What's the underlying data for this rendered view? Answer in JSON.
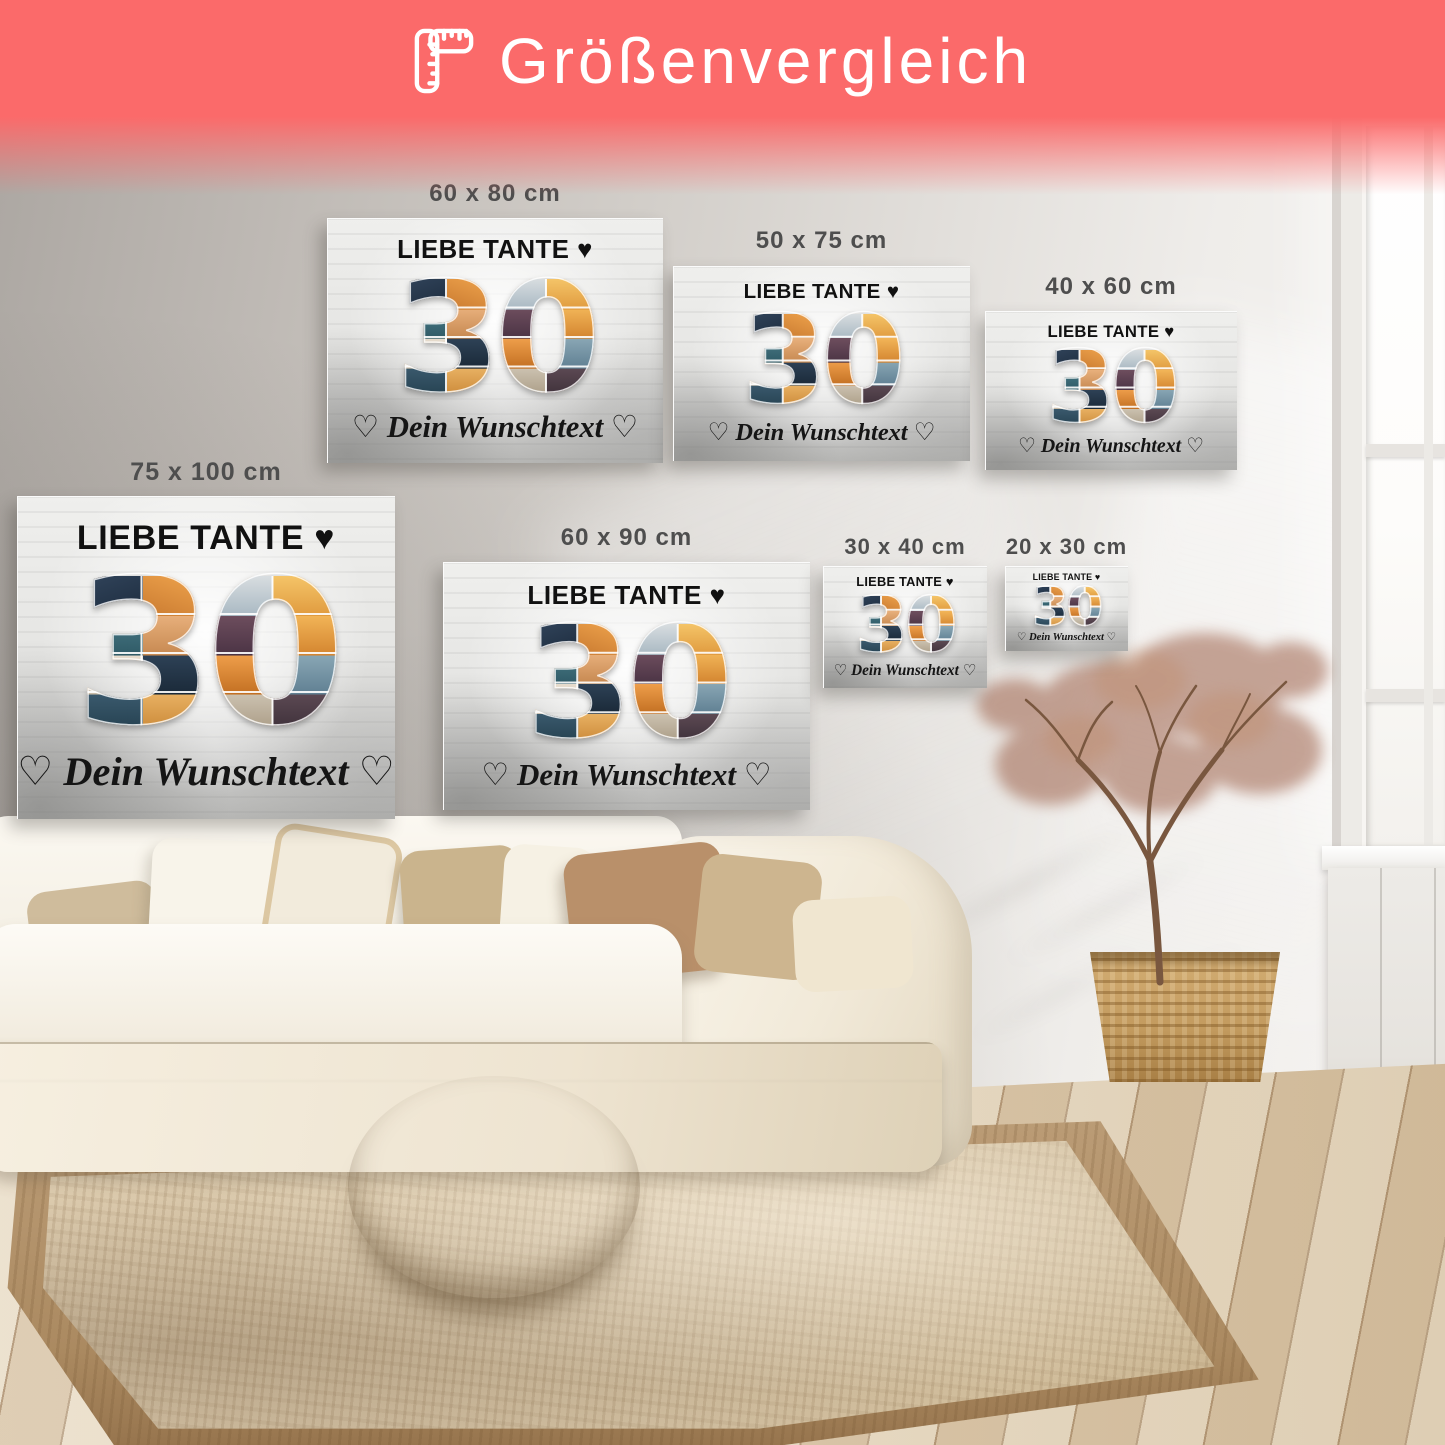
{
  "header": {
    "title": "Größenvergleich",
    "icon": "ruler-icon",
    "banner_color": "#fb6a6a",
    "text_color": "#ffffff"
  },
  "canvas_design": {
    "headline": "LIEBE TANTE ♥",
    "number": "30",
    "subtitle": "♡ Dein Wunschtext ♡"
  },
  "sizes": [
    {
      "label": "60 x 80 cm"
    },
    {
      "label": "50 x 75 cm"
    },
    {
      "label": "40 x 60 cm"
    },
    {
      "label": "75 x 100 cm"
    },
    {
      "label": "60 x 90 cm"
    },
    {
      "label": "30 x 40 cm"
    },
    {
      "label": "20 x 30 cm"
    }
  ],
  "colors": {
    "size_label_text": "#4e4e4e",
    "canvas_text": "#111111"
  }
}
